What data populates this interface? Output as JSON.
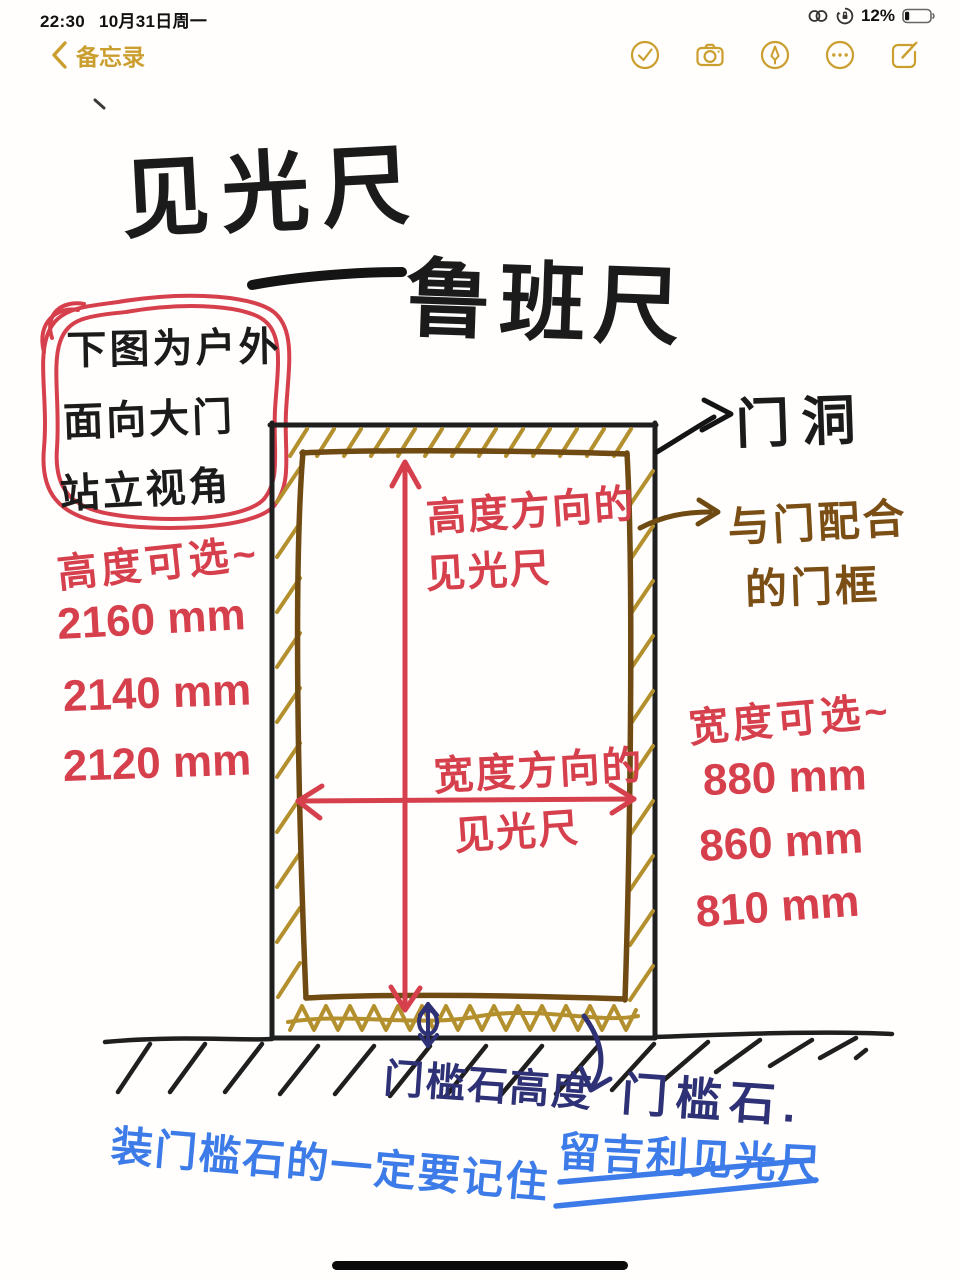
{
  "status_bar": {
    "time": "22:30",
    "date": "10月31日周一",
    "battery_percent": "12%",
    "icons": [
      "personal-hotspot-icon",
      "orientation-lock-icon",
      "battery-icon"
    ]
  },
  "nav_bar": {
    "back_label": "备忘录",
    "action_icons": [
      "checklist-icon",
      "camera-icon",
      "markup-icon",
      "more-icon",
      "compose-icon"
    ]
  },
  "sketch": {
    "title": {
      "line1": "见光尺",
      "connector": "——",
      "line2": "鲁班尺"
    },
    "circled_note": {
      "line1": "下图为户外",
      "line2": "面向大门",
      "line3": "站立视角"
    },
    "height_section": {
      "label": "高度可选~",
      "options": [
        "2160 mm",
        "2140 mm",
        "2120 mm"
      ]
    },
    "width_section": {
      "label": "宽度可选~",
      "options": [
        "880 mm",
        "860 mm",
        "810 mm"
      ]
    },
    "vertical_arrow_label": {
      "line1": "高度方向的",
      "line2": "见光尺"
    },
    "horizontal_arrow_label": {
      "line1": "宽度方向的",
      "line2": "见光尺"
    },
    "door_opening_label": "门洞",
    "door_frame_label": {
      "line1": "与门配合",
      "line2": "的门框"
    },
    "threshold_height_label": "门槛石高度",
    "threshold_stone_label": "门槛石.",
    "blue_note": {
      "part1": "装门槛石的一定要记住",
      "part2": "留吉利见光尺"
    }
  },
  "colors": {
    "ui_gold": "#cb9f2f",
    "ink_black": "#1b1b1b",
    "pen_red": "#d6404d",
    "pen_gold": "#b3902d",
    "pen_brown": "#6f4a12",
    "pen_navy": "#2e3175",
    "pen_blue": "#3d7ce8"
  }
}
